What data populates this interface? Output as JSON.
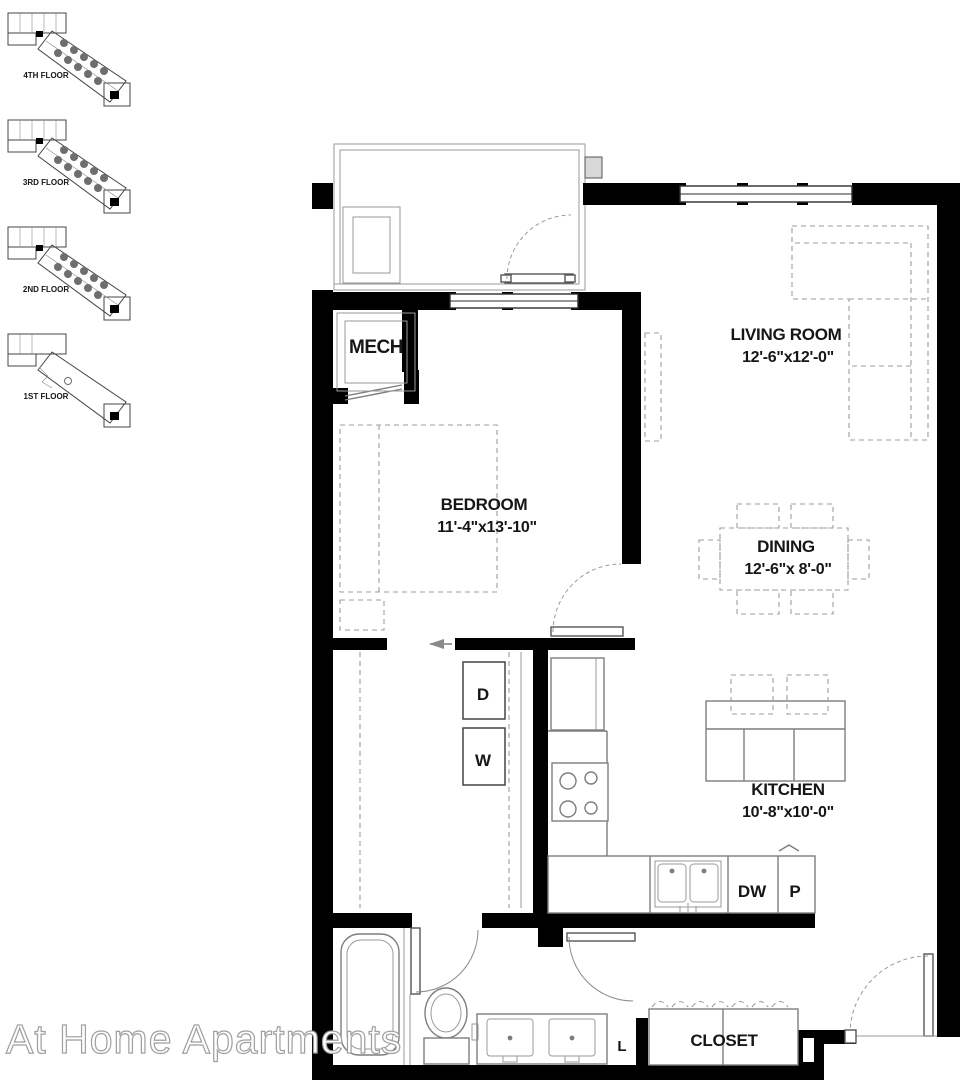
{
  "watermark": {
    "text": "At Home Apartments"
  },
  "floors": [
    {
      "label": "4TH FLOOR"
    },
    {
      "label": "3RD FLOOR"
    },
    {
      "label": "2ND FLOOR"
    },
    {
      "label": "1ST FLOOR"
    }
  ],
  "rooms": {
    "mech": {
      "name": "MECH"
    },
    "bedroom": {
      "name": "BEDROOM",
      "dims": "11'-4\"x13'-10\""
    },
    "living": {
      "name": "LIVING ROOM",
      "dims": "12'-6\"x12'-0\""
    },
    "dining": {
      "name": "DINING",
      "dims": "12'-6\"x 8'-0\""
    },
    "kitchen": {
      "name": "KITCHEN",
      "dims": "10'-8\"x10'-0\""
    },
    "closet": {
      "name": "CLOSET"
    }
  },
  "fixtures": {
    "dryer": "D",
    "washer": "W",
    "dishwasher": "DW",
    "pantry": "P",
    "linen": "L"
  },
  "colors": {
    "wall": "#000000",
    "fixture_line": "#7d7d7d",
    "dashed_furniture": "#9d9d9d",
    "background": "#ffffff"
  }
}
